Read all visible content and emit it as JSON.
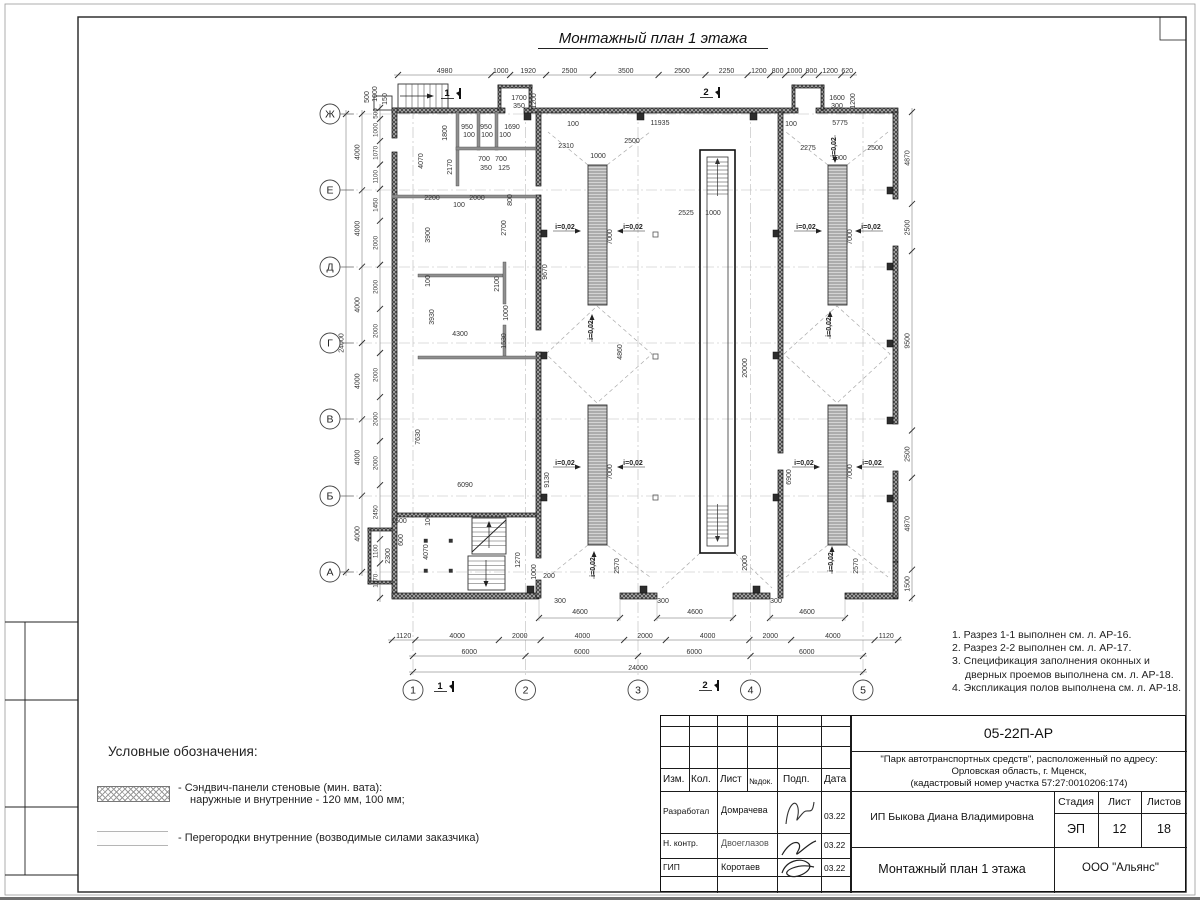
{
  "sheet_title": "Монтажный план 1 этажа",
  "notes": [
    "1. Разрез 1-1 выполнен см. л. АР-16.",
    "2. Разрез 2-2 выполнен см. л. АР-17.",
    "3. Спецификация заполнения оконных и дверных проемов выполнена см. л. АР-18.",
    "4. Экспликация полов выполнена см. л. АР-18."
  ],
  "legend": {
    "header": "Условные обозначения:",
    "item1_line1": "- Сэндвич-панели стеновые (мин. вата):",
    "item1_line2": "наружные и внутренние - 120 мм, 100 мм;",
    "item2": "- Перегородки внутренние (возводимые силами заказчика)"
  },
  "titleblock": {
    "doc_code": "05-22П-АР",
    "project_line1": "\"Парк автотранспортных средств\",  расположенный по адресу:",
    "project_line2": "Орловская область, г. Мценск,",
    "project_line3": "(кадастровый номер участка 57:27:0010206:174)",
    "client": "ИП Быкова Диана Владимировна",
    "sheet_name": "Монтажный план 1 этажа",
    "company": "ООО \"Альянс\"",
    "col_izm": "Изм.",
    "col_kol": "Кол.",
    "col_list": "Лист",
    "col_ndok": "№док.",
    "col_podp": "Подп.",
    "col_data": "Дата",
    "stage_h": "Стадия",
    "list_h": "Лист",
    "listov_h": "Листов",
    "stage": "ЭП",
    "list_no": "12",
    "listov": "18",
    "rows": [
      {
        "role": "Разработал",
        "name": "Домрачева",
        "date": "03.22"
      },
      {
        "role": "Н. контр.",
        "name": "Двоеглазов",
        "date": "03.22"
      },
      {
        "role": "ГИП",
        "name": "Коротаев",
        "date": "03.22"
      }
    ]
  },
  "plan": {
    "axes_rows": [
      "Ж",
      "Е",
      "Д",
      "Г",
      "В",
      "Б",
      "А"
    ],
    "axes_cols": [
      "1",
      "2",
      "3",
      "4",
      "5"
    ],
    "slope_label": "i=0,02",
    "section_marks_top": [
      [
        "1",
        447,
        96
      ],
      [
        "2",
        706,
        95
      ]
    ],
    "section_marks_bottom": [
      [
        "1",
        440,
        689
      ],
      [
        "2",
        705,
        688
      ]
    ],
    "chains": {
      "top": [
        "4980",
        "1000",
        "1920",
        "2500",
        "3500",
        "2500",
        "2250",
        "1200",
        "800",
        "1000",
        "800",
        "1200",
        "620"
      ],
      "left_outer": [
        "4000",
        "4000",
        "4000",
        "4000",
        "4000",
        "4000"
      ],
      "left_total": [
        "24000"
      ],
      "left_inner": [
        "500",
        "1000",
        "1070",
        "1100",
        "1450",
        "2000",
        "2000",
        "2000",
        "2000",
        "2000",
        "2000",
        "2450",
        "1100",
        "1570"
      ],
      "right": [
        "4870",
        "2500",
        "9500",
        "2500",
        "4870",
        "1500"
      ],
      "bottom_inner": [
        "1120",
        "4000",
        "2000",
        "4000",
        "2000",
        "4000",
        "2000",
        "4000",
        "1120"
      ],
      "bottom_mid": [
        "6000",
        "6000",
        "6000",
        "6000"
      ],
      "bottom_total": [
        "24000"
      ]
    },
    "dims": [
      [
        "1700",
        519,
        100,
        0
      ],
      [
        "350",
        519,
        108,
        0
      ],
      [
        "1200",
        536,
        101,
        1
      ],
      [
        "500",
        369,
        97,
        1
      ],
      [
        "1000",
        377,
        94,
        1
      ],
      [
        "150",
        387,
        99,
        1
      ],
      [
        "1600",
        837,
        100,
        0
      ],
      [
        "300",
        837,
        108,
        0
      ],
      [
        "1200",
        855,
        101,
        1
      ],
      [
        "100",
        573,
        126,
        0
      ],
      [
        "11935",
        660,
        125,
        0
      ],
      [
        "100",
        791,
        126,
        0
      ],
      [
        "5775",
        840,
        125,
        0
      ],
      [
        "2310",
        566,
        148,
        0
      ],
      [
        "2500",
        632,
        143,
        0
      ],
      [
        "1000",
        598,
        158,
        0
      ],
      [
        "2275",
        808,
        150,
        0
      ],
      [
        "2500",
        875,
        150,
        0
      ],
      [
        "1000",
        839,
        160,
        0
      ],
      [
        "2525",
        686,
        215,
        0
      ],
      [
        "1000",
        713,
        215,
        0
      ],
      [
        "7000",
        612,
        237,
        1
      ],
      [
        "7000",
        852,
        237,
        1
      ],
      [
        "9670",
        547,
        272,
        1
      ],
      [
        "4860",
        622,
        352,
        1
      ],
      [
        "20000",
        747,
        368,
        1
      ],
      [
        "7000",
        612,
        472,
        1
      ],
      [
        "7000",
        852,
        472,
        1
      ],
      [
        "6900",
        791,
        477,
        1
      ],
      [
        "9130",
        549,
        480,
        1
      ],
      [
        "7630",
        420,
        437,
        1
      ],
      [
        "2570",
        619,
        566,
        1
      ],
      [
        "2570",
        858,
        566,
        1
      ],
      [
        "2000",
        747,
        563,
        1
      ],
      [
        "950",
        467,
        129,
        0
      ],
      [
        "950",
        486,
        129,
        0
      ],
      [
        "1690",
        512,
        129,
        0
      ],
      [
        "100",
        469,
        137,
        0
      ],
      [
        "100",
        487,
        137,
        0
      ],
      [
        "100",
        505,
        137,
        0
      ],
      [
        "1800",
        447,
        133,
        1
      ],
      [
        "4070",
        423,
        161,
        1
      ],
      [
        "2170",
        452,
        167,
        1
      ],
      [
        "700",
        484,
        161,
        0
      ],
      [
        "700",
        501,
        161,
        0
      ],
      [
        "350",
        486,
        170,
        0
      ],
      [
        "125",
        504,
        170,
        0
      ],
      [
        "2200",
        432,
        200,
        0
      ],
      [
        "2000",
        477,
        200,
        0
      ],
      [
        "100",
        459,
        207,
        0
      ],
      [
        "3900",
        430,
        235,
        1
      ],
      [
        "2700",
        506,
        228,
        1
      ],
      [
        "800",
        512,
        200,
        1
      ],
      [
        "100",
        430,
        281,
        1
      ],
      [
        "3930",
        434,
        317,
        1
      ],
      [
        "2100",
        499,
        284,
        1
      ],
      [
        "1000",
        508,
        313,
        1
      ],
      [
        "1530",
        506,
        341,
        1
      ],
      [
        "4300",
        460,
        336,
        0
      ],
      [
        "6090",
        465,
        487,
        0
      ],
      [
        "100",
        430,
        520,
        1
      ],
      [
        "4070",
        428,
        552,
        1
      ],
      [
        "1270",
        520,
        560,
        1
      ],
      [
        "1000",
        536,
        572,
        1
      ],
      [
        "200",
        549,
        578,
        0
      ],
      [
        "1500",
        399,
        523,
        0
      ],
      [
        "600",
        403,
        540,
        1
      ],
      [
        "2300",
        390,
        556,
        1
      ],
      [
        "300",
        560,
        603,
        0
      ],
      [
        "300",
        663,
        603,
        0
      ],
      [
        "300",
        776,
        603,
        0
      ],
      [
        "4600",
        580,
        614,
        0
      ],
      [
        "4600",
        695,
        614,
        0
      ],
      [
        "4600",
        807,
        614,
        0
      ]
    ],
    "slopes": [
      [
        565,
        229,
        "r"
      ],
      [
        633,
        229,
        "l"
      ],
      [
        806,
        229,
        "r"
      ],
      [
        871,
        229,
        "l"
      ],
      [
        565,
        465,
        "r"
      ],
      [
        633,
        465,
        "l"
      ],
      [
        804,
        465,
        "r"
      ],
      [
        872,
        465,
        "l"
      ],
      [
        593,
        330,
        "u"
      ],
      [
        831,
        327,
        "u"
      ],
      [
        595,
        567,
        "u"
      ],
      [
        833,
        562,
        "u"
      ],
      [
        836,
        147,
        "d"
      ]
    ]
  }
}
